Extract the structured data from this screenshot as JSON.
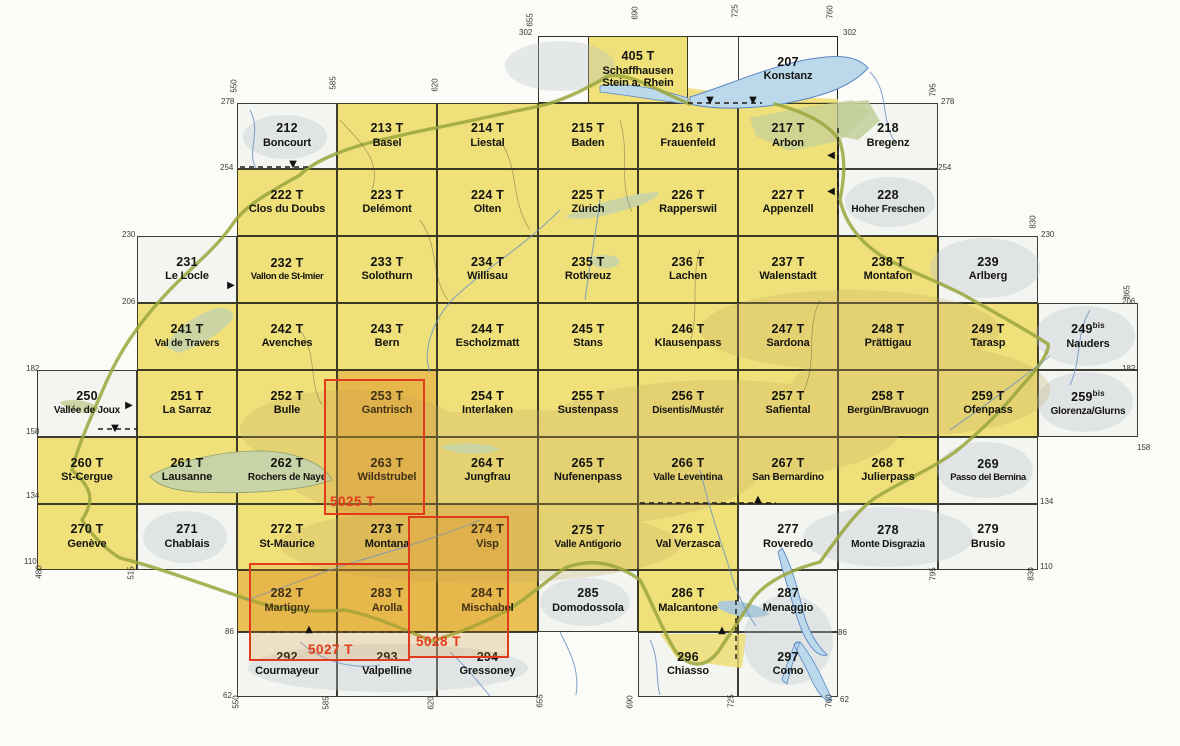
{
  "map_title": "Swiss national map 1:50 000 sheet index",
  "colors": {
    "yellow": "#efe079",
    "orange": "#e8c055",
    "white": "#f3f5f1",
    "overlay_red": "#e23a1c",
    "grid_line": "#1c1c14",
    "lake_blue": "#bcd9ec",
    "lake_green": "#cbd5a4",
    "border_green": "#9aa63c"
  },
  "grid": {
    "col_edges": [
      37,
      137,
      237,
      337,
      437,
      538,
      638,
      738,
      838,
      938,
      1038,
      1138
    ],
    "row_edges": [
      36,
      103,
      169,
      236,
      303,
      370,
      437,
      504,
      570,
      632,
      697
    ]
  },
  "frames": [
    {
      "x": 538,
      "y": 36,
      "w": 300,
      "h": 67
    }
  ],
  "cells": [
    {
      "n": "405 T",
      "m": "Schaffhausen Stein a. Rhein",
      "f": "yellow",
      "px": [
        588,
        36,
        100,
        67
      ],
      "wrap": true
    },
    {
      "n": "207",
      "m": "Konstanz",
      "f": "none",
      "px": [
        738,
        36,
        100,
        67
      ]
    },
    {
      "n": "212",
      "m": "Boncourt",
      "f": "white",
      "c": 2,
      "r": 1
    },
    {
      "n": "213 T",
      "m": "Basel",
      "f": "yellow",
      "c": 3,
      "r": 1
    },
    {
      "n": "214 T",
      "m": "Liestal",
      "f": "yellow",
      "c": 4,
      "r": 1
    },
    {
      "n": "215 T",
      "m": "Baden",
      "f": "yellow",
      "c": 5,
      "r": 1
    },
    {
      "n": "216 T",
      "m": "Frauenfeld",
      "f": "yellow",
      "c": 6,
      "r": 1
    },
    {
      "n": "217 T",
      "m": "Arbon",
      "f": "yellow",
      "c": 7,
      "r": 1
    },
    {
      "n": "218",
      "m": "Bregenz",
      "f": "white",
      "c": 8,
      "r": 1
    },
    {
      "n": "222 T",
      "m": "Clos du Doubs",
      "f": "yellow",
      "c": 2,
      "r": 2
    },
    {
      "n": "223 T",
      "m": "Delémont",
      "f": "yellow",
      "c": 3,
      "r": 2
    },
    {
      "n": "224 T",
      "m": "Olten",
      "f": "yellow",
      "c": 4,
      "r": 2
    },
    {
      "n": "225 T",
      "m": "Zürich",
      "f": "yellow",
      "c": 5,
      "r": 2
    },
    {
      "n": "226 T",
      "m": "Rapperswil",
      "f": "yellow",
      "c": 6,
      "r": 2
    },
    {
      "n": "227 T",
      "m": "Appenzell",
      "f": "yellow",
      "c": 7,
      "r": 2
    },
    {
      "n": "228",
      "m": "Hoher Freschen",
      "f": "white",
      "c": 8,
      "r": 2
    },
    {
      "n": "231",
      "m": "Le Locle",
      "f": "white",
      "c": 1,
      "r": 3
    },
    {
      "n": "232 T",
      "m": "Vallon de St-Imier",
      "f": "yellow",
      "c": 2,
      "r": 3
    },
    {
      "n": "233 T",
      "m": "Solothurn",
      "f": "yellow",
      "c": 3,
      "r": 3
    },
    {
      "n": "234 T",
      "m": "Willisau",
      "f": "yellow",
      "c": 4,
      "r": 3
    },
    {
      "n": "235 T",
      "m": "Rotkreuz",
      "f": "yellow",
      "c": 5,
      "r": 3
    },
    {
      "n": "236 T",
      "m": "Lachen",
      "f": "yellow",
      "c": 6,
      "r": 3
    },
    {
      "n": "237 T",
      "m": "Walenstadt",
      "f": "yellow",
      "c": 7,
      "r": 3
    },
    {
      "n": "238 T",
      "m": "Montafon",
      "f": "yellow",
      "c": 8,
      "r": 3
    },
    {
      "n": "239",
      "m": "Arlberg",
      "f": "white",
      "c": 9,
      "r": 3
    },
    {
      "n": "241 T",
      "m": "Val de Travers",
      "f": "yellow",
      "c": 1,
      "r": 4
    },
    {
      "n": "242 T",
      "m": "Avenches",
      "f": "yellow",
      "c": 2,
      "r": 4
    },
    {
      "n": "243 T",
      "m": "Bern",
      "f": "yellow",
      "c": 3,
      "r": 4
    },
    {
      "n": "244 T",
      "m": "Escholzmatt",
      "f": "yellow",
      "c": 4,
      "r": 4
    },
    {
      "n": "245 T",
      "m": "Stans",
      "f": "yellow",
      "c": 5,
      "r": 4
    },
    {
      "n": "246 T",
      "m": "Klausenpass",
      "f": "yellow",
      "c": 6,
      "r": 4
    },
    {
      "n": "247 T",
      "m": "Sardona",
      "f": "yellow",
      "c": 7,
      "r": 4
    },
    {
      "n": "248 T",
      "m": "Prättigau",
      "f": "yellow",
      "c": 8,
      "r": 4
    },
    {
      "n": "249 T",
      "m": "Tarasp",
      "f": "yellow",
      "c": 9,
      "r": 4
    },
    {
      "n": "249",
      "s": "bis",
      "m": "Nauders",
      "f": "white",
      "c": 10,
      "r": 4
    },
    {
      "n": "250",
      "m": "Vallée de Joux",
      "f": "white",
      "c": 0,
      "r": 5
    },
    {
      "n": "251 T",
      "m": "La Sarraz",
      "f": "yellow",
      "c": 1,
      "r": 5
    },
    {
      "n": "252 T",
      "m": "Bulle",
      "f": "yellow",
      "c": 2,
      "r": 5
    },
    {
      "n": "253 T",
      "m": "Gantrisch",
      "f": "orange",
      "c": 3,
      "r": 5
    },
    {
      "n": "254 T",
      "m": "Interlaken",
      "f": "yellow",
      "c": 4,
      "r": 5
    },
    {
      "n": "255 T",
      "m": "Sustenpass",
      "f": "yellow",
      "c": 5,
      "r": 5
    },
    {
      "n": "256 T",
      "m": "Disentis/Mustér",
      "f": "yellow",
      "c": 6,
      "r": 5
    },
    {
      "n": "257 T",
      "m": "Safiental",
      "f": "yellow",
      "c": 7,
      "r": 5
    },
    {
      "n": "258 T",
      "m": "Bergün/Bravuogn",
      "f": "yellow",
      "c": 8,
      "r": 5
    },
    {
      "n": "259 T",
      "m": "Ofenpass",
      "f": "yellow",
      "c": 9,
      "r": 5
    },
    {
      "n": "259",
      "s": "bis",
      "m": "Glorenza/Glurns",
      "f": "white",
      "c": 10,
      "r": 5
    },
    {
      "n": "260 T",
      "m": "St-Cergue",
      "f": "yellow",
      "c": 0,
      "r": 6
    },
    {
      "n": "261 T",
      "m": "Lausanne",
      "f": "yellow",
      "c": 1,
      "r": 6
    },
    {
      "n": "262 T",
      "m": "Rochers de Naye",
      "f": "yellow",
      "c": 2,
      "r": 6
    },
    {
      "n": "263 T",
      "m": "Wildstrubel",
      "f": "orange",
      "c": 3,
      "r": 6
    },
    {
      "n": "264 T",
      "m": "Jungfrau",
      "f": "yellow",
      "c": 4,
      "r": 6
    },
    {
      "n": "265 T",
      "m": "Nufenenpass",
      "f": "yellow",
      "c": 5,
      "r": 6
    },
    {
      "n": "266 T",
      "m": "Valle Leventina",
      "f": "yellow",
      "c": 6,
      "r": 6
    },
    {
      "n": "267 T",
      "m": "San Bernardino",
      "f": "yellow",
      "c": 7,
      "r": 6
    },
    {
      "n": "268 T",
      "m": "Julierpass",
      "f": "yellow",
      "c": 8,
      "r": 6
    },
    {
      "n": "269",
      "m": "Passo del Bernina",
      "f": "white",
      "c": 9,
      "r": 6
    },
    {
      "n": "270 T",
      "m": "Genève",
      "f": "yellow",
      "c": 0,
      "r": 7
    },
    {
      "n": "271",
      "m": "Chablais",
      "f": "white",
      "c": 1,
      "r": 7
    },
    {
      "n": "272 T",
      "m": "St-Maurice",
      "f": "yellow",
      "c": 2,
      "r": 7
    },
    {
      "n": "273 T",
      "m": "Montana",
      "f": "orange",
      "c": 3,
      "r": 7
    },
    {
      "n": "274 T",
      "m": "Visp",
      "f": "orange",
      "c": 4,
      "r": 7
    },
    {
      "n": "275 T",
      "m": "Valle Antigorio",
      "f": "yellow",
      "c": 5,
      "r": 7
    },
    {
      "n": "276 T",
      "m": "Val Verzasca",
      "f": "yellow",
      "c": 6,
      "r": 7
    },
    {
      "n": "277",
      "m": "Roveredo",
      "f": "white",
      "c": 7,
      "r": 7
    },
    {
      "n": "278",
      "m": "Monte Disgrazia",
      "f": "white",
      "c": 8,
      "r": 7
    },
    {
      "n": "279",
      "m": "Brusio",
      "f": "white",
      "c": 9,
      "r": 7
    },
    {
      "n": "282 T",
      "m": "Martigny",
      "f": "orange",
      "c": 2,
      "r": 8
    },
    {
      "n": "283 T",
      "m": "Arolla",
      "f": "orange",
      "c": 3,
      "r": 8
    },
    {
      "n": "284 T",
      "m": "Mischabel",
      "f": "orange",
      "c": 4,
      "r": 8
    },
    {
      "n": "285",
      "m": "Domodossola",
      "f": "white",
      "c": 5,
      "r": 8
    },
    {
      "n": "286 T",
      "m": "Malcantone",
      "f": "yellow",
      "c": 6,
      "r": 8
    },
    {
      "n": "287",
      "m": "Menaggio",
      "f": "white",
      "c": 7,
      "r": 8
    },
    {
      "n": "292",
      "m": "Courmayeur",
      "f": "white",
      "c": 2,
      "r": 9
    },
    {
      "n": "293",
      "m": "Valpelline",
      "f": "white",
      "c": 3,
      "r": 9
    },
    {
      "n": "294",
      "m": "Gressoney",
      "f": "white",
      "c": 4,
      "r": 9
    },
    {
      "n": "296",
      "m": "Chiasso",
      "f": "white",
      "c": 6,
      "r": 9
    },
    {
      "n": "297",
      "m": "Como",
      "f": "white",
      "c": 7,
      "r": 9
    }
  ],
  "composite_sheets": [
    {
      "label": "5025 T",
      "x": 324,
      "y": 379,
      "w": 101,
      "h": 136,
      "label_x": 330,
      "label_y": 494
    },
    {
      "label": "5027 T",
      "x": 249,
      "y": 563,
      "w": 161,
      "h": 98,
      "label_x": 308,
      "label_y": 642
    },
    {
      "label": "5028 T",
      "x": 408,
      "y": 516,
      "w": 101,
      "h": 142,
      "label_x": 416,
      "label_y": 634
    }
  ],
  "edge_labels": [
    {
      "t": "302",
      "x": 519,
      "y": 28
    },
    {
      "t": "302",
      "x": 843,
      "y": 28
    },
    {
      "t": "278",
      "x": 221,
      "y": 97
    },
    {
      "t": "254",
      "x": 220,
      "y": 163
    },
    {
      "t": "230",
      "x": 122,
      "y": 230
    },
    {
      "t": "206",
      "x": 122,
      "y": 297
    },
    {
      "t": "182",
      "x": 26,
      "y": 364
    },
    {
      "t": "158",
      "x": 26,
      "y": 427
    },
    {
      "t": "134",
      "x": 26,
      "y": 491
    },
    {
      "t": "110",
      "x": 24,
      "y": 557
    },
    {
      "t": "86",
      "x": 225,
      "y": 627
    },
    {
      "t": "62",
      "x": 223,
      "y": 691
    },
    {
      "t": "278",
      "x": 941,
      "y": 97
    },
    {
      "t": "254",
      "x": 938,
      "y": 163
    },
    {
      "t": "230",
      "x": 1041,
      "y": 230
    },
    {
      "t": "206",
      "x": 1122,
      "y": 297
    },
    {
      "t": "182",
      "x": 1122,
      "y": 364
    },
    {
      "t": "158",
      "x": 1137,
      "y": 443
    },
    {
      "t": "134",
      "x": 1040,
      "y": 497
    },
    {
      "t": "110",
      "x": 1040,
      "y": 562
    },
    {
      "t": "86",
      "x": 838,
      "y": 628
    },
    {
      "t": "62",
      "x": 840,
      "y": 695
    },
    {
      "t": "550",
      "x": 234,
      "y": 86,
      "v": true
    },
    {
      "t": "585",
      "x": 333,
      "y": 83,
      "v": true
    },
    {
      "t": "620",
      "x": 435,
      "y": 85,
      "v": true
    },
    {
      "t": "655",
      "x": 530,
      "y": 20,
      "v": true
    },
    {
      "t": "690",
      "x": 635,
      "y": 13,
      "v": true
    },
    {
      "t": "725",
      "x": 735,
      "y": 11,
      "v": true
    },
    {
      "t": "760",
      "x": 830,
      "y": 12,
      "v": true
    },
    {
      "t": "795",
      "x": 933,
      "y": 90,
      "v": true
    },
    {
      "t": "830",
      "x": 1033,
      "y": 222,
      "v": true
    },
    {
      "t": "865",
      "x": 1127,
      "y": 292,
      "v": true
    },
    {
      "t": "480",
      "x": 39,
      "y": 572,
      "v": true
    },
    {
      "t": "515",
      "x": 131,
      "y": 573,
      "v": true
    },
    {
      "t": "795",
      "x": 933,
      "y": 574,
      "v": true
    },
    {
      "t": "830",
      "x": 1031,
      "y": 574,
      "v": true
    },
    {
      "t": "550",
      "x": 236,
      "y": 702,
      "v": true
    },
    {
      "t": "585",
      "x": 326,
      "y": 703,
      "v": true
    },
    {
      "t": "620",
      "x": 431,
      "y": 703,
      "v": true
    },
    {
      "t": "655",
      "x": 540,
      "y": 701,
      "v": true
    },
    {
      "t": "690",
      "x": 630,
      "y": 702,
      "v": true
    },
    {
      "t": "725",
      "x": 731,
      "y": 701,
      "v": true
    },
    {
      "t": "760",
      "x": 829,
      "y": 701,
      "v": true
    }
  ],
  "arrow_markers": [
    {
      "dir": "down",
      "x": 710,
      "y": 101
    },
    {
      "dir": "down",
      "x": 753,
      "y": 101
    },
    {
      "dir": "down",
      "x": 293,
      "y": 165
    },
    {
      "dir": "left",
      "x": 831,
      "y": 156
    },
    {
      "dir": "left",
      "x": 831,
      "y": 192
    },
    {
      "dir": "right",
      "x": 231,
      "y": 286
    },
    {
      "dir": "right",
      "x": 129,
      "y": 406
    },
    {
      "dir": "down",
      "x": 115,
      "y": 429
    },
    {
      "dir": "up",
      "x": 758,
      "y": 500
    },
    {
      "dir": "up",
      "x": 309,
      "y": 630
    },
    {
      "dir": "up",
      "x": 722,
      "y": 631
    }
  ],
  "dashed_lines": [
    {
      "x1": 688,
      "y1": 103,
      "x2": 762,
      "y2": 103
    },
    {
      "x1": 240,
      "y1": 167,
      "x2": 312,
      "y2": 167
    },
    {
      "x1": 838,
      "y1": 128,
      "x2": 838,
      "y2": 214
    },
    {
      "x1": 640,
      "y1": 503,
      "x2": 776,
      "y2": 503
    },
    {
      "x1": 262,
      "y1": 632,
      "x2": 418,
      "y2": 632
    },
    {
      "x1": 736,
      "y1": 600,
      "x2": 736,
      "y2": 662
    },
    {
      "x1": 98,
      "y1": 429,
      "x2": 137,
      "y2": 429
    }
  ]
}
